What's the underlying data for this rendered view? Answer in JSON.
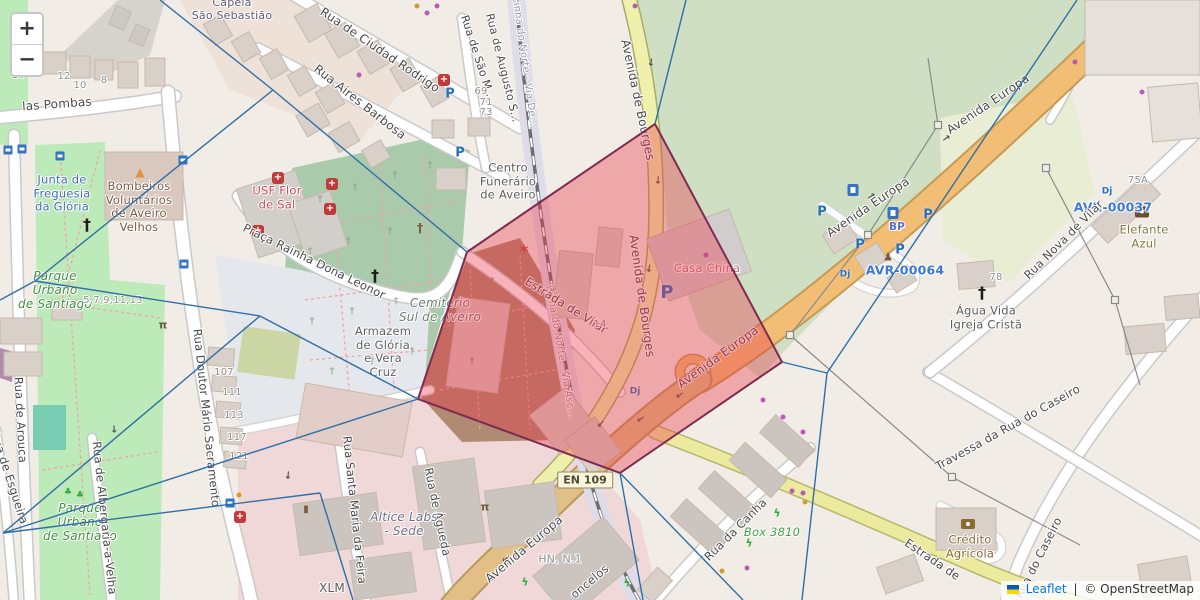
{
  "controls": {
    "zoom_in": "+",
    "zoom_out": "−"
  },
  "attribution": {
    "leaflet_link": "Leaflet",
    "separator": "|",
    "osm_text": "© OpenStreetMap"
  },
  "road_ref_badge": {
    "text": "EN 109",
    "x": 585,
    "y": 480
  },
  "overlay": {
    "voronoi_color": "#2f6fa8",
    "cell_stroke": "#7d2b50",
    "cell_fill": "rgba(235,55,70,0.38)",
    "cell_points": [
      [
        655,
        124
      ],
      [
        782,
        362
      ],
      [
        620,
        473
      ],
      [
        418,
        399
      ],
      [
        467,
        252
      ],
      [
        533,
        207
      ]
    ],
    "voronoi_segments": [
      [
        [
          160,
          0
        ],
        [
          273,
          90
        ]
      ],
      [
        [
          273,
          90
        ],
        [
          467,
          252
        ]
      ],
      [
        [
          35,
          281
        ],
        [
          273,
          90
        ]
      ],
      [
        [
          0,
          300
        ],
        [
          35,
          281
        ]
      ],
      [
        [
          35,
          281
        ],
        [
          260,
          316
        ]
      ],
      [
        [
          260,
          316
        ],
        [
          418,
          399
        ]
      ],
      [
        [
          260,
          316
        ],
        [
          3,
          533
        ]
      ],
      [
        [
          3,
          533
        ],
        [
          320,
          493
        ]
      ],
      [
        [
          320,
          493
        ],
        [
          353,
          600
        ]
      ],
      [
        [
          3,
          533
        ],
        [
          418,
          399
        ]
      ],
      [
        [
          620,
          473
        ],
        [
          643,
          600
        ]
      ],
      [
        [
          620,
          473
        ],
        [
          743,
          600
        ]
      ],
      [
        [
          655,
          124
        ],
        [
          686,
          0
        ]
      ],
      [
        [
          1077,
          0
        ],
        [
          827,
          373
        ]
      ],
      [
        [
          827,
          373
        ],
        [
          782,
          362
        ]
      ],
      [
        [
          827,
          373
        ],
        [
          802,
          600
        ]
      ]
    ]
  },
  "power_lines": [
    {
      "d": "M928,58 L938,125 L868,235 L790,335 L952,477 L1080,545",
      "pylons": [
        [
          938,
          125
        ],
        [
          868,
          235
        ],
        [
          790,
          335
        ],
        [
          952,
          477
        ]
      ]
    },
    {
      "d": "M1046,168 L1115,300 L1140,385",
      "pylons": [
        [
          1046,
          168
        ],
        [
          1115,
          300
        ]
      ]
    }
  ],
  "labels": [
    {
      "n": "street-rua-das-pombas",
      "t": "las Pombas",
      "x": 57,
      "y": 104,
      "r": -4,
      "s": 12
    },
    {
      "n": "poi-capela-sao-sebastiao",
      "t": "Capela\nSão Sebastião",
      "x": 232,
      "y": 10,
      "s": 11,
      "c": "#5b5b74"
    },
    {
      "n": "street-ciudad-rodrigo",
      "t": "Rua de Ciudad Rodrigo",
      "x": 380,
      "y": 50,
      "r": 34,
      "s": 12
    },
    {
      "n": "street-aires-barbosa",
      "t": "Rua Aires Barbosa",
      "x": 360,
      "y": 102,
      "r": 38,
      "s": 12
    },
    {
      "n": "street-sao-m",
      "t": "Rua de São M...",
      "x": 477,
      "y": 58,
      "r": 72,
      "s": 11
    },
    {
      "n": "street-augusto-s",
      "t": "Rua de Augusto S...",
      "x": 502,
      "y": 68,
      "r": 76,
      "s": 11
    },
    {
      "n": "railway-linha-do-norte-1",
      "t": "Linha do Norte - Via De...",
      "x": 524,
      "y": 62,
      "r": 82,
      "s": 10,
      "c": "#9595ab"
    },
    {
      "n": "railway-linha-do-norte-2",
      "t": "Linha do Norte - Via Asc...",
      "x": 560,
      "y": 352,
      "r": 80,
      "s": 10,
      "c": "#a08a93"
    },
    {
      "n": "road-bourges-1",
      "t": "Avenida de Bourges",
      "x": 638,
      "y": 100,
      "r": 78,
      "s": 12
    },
    {
      "n": "road-bourges-2",
      "t": "Avenida de Bourges",
      "x": 642,
      "y": 296,
      "r": 82,
      "s": 12
    },
    {
      "n": "poi-centro-funerario",
      "t": "Centro\nFunerário\nde Aveiro",
      "x": 508,
      "y": 182,
      "s": 11.5,
      "c": "#5d5d5d"
    },
    {
      "n": "poi-junta-freguesia",
      "t": "Junta de\nFreguesia\nda Glória",
      "x": 62,
      "y": 194,
      "s": 11.5,
      "c": "#3f6fb5"
    },
    {
      "n": "poi-bombeiros",
      "t": "Bombeiros\nVoluntários\nde Aveiro\nVelhos",
      "x": 139,
      "y": 207,
      "s": 11.5,
      "c": "#7a5948"
    },
    {
      "n": "poi-usf-flor-de-sal",
      "t": "USF Flor\nde Sal",
      "x": 277,
      "y": 198,
      "s": 11.5,
      "c": "#c5494f"
    },
    {
      "n": "street-praca-leonor",
      "t": "Praça Rainha Dona Leonor",
      "x": 314,
      "y": 262,
      "r": 26,
      "s": 11.5
    },
    {
      "n": "poi-parque-santiago-1",
      "t": "Parque\nUrbano\nde Santiago",
      "x": 55,
      "y": 290,
      "s": 12,
      "c": "#3f9143",
      "st": "i"
    },
    {
      "n": "poi-parque-santiago-2",
      "t": "Parque\nUrbano\nde Santiago",
      "x": 80,
      "y": 522,
      "s": 12,
      "c": "#3f9143",
      "st": "i"
    },
    {
      "n": "housenumbers-5-13",
      "t": "5,7,9,11,13",
      "x": 113,
      "y": 301,
      "s": 10,
      "c": "#8f8f8f"
    },
    {
      "n": "street-arouca",
      "t": "Rua de Arouca",
      "x": 20,
      "y": 420,
      "r": 87,
      "s": 11.5
    },
    {
      "n": "street-sacramento",
      "t": "Rua Doutor Mário Sacramento",
      "x": 206,
      "y": 418,
      "r": 84,
      "s": 11.5
    },
    {
      "n": "street-santa-maria",
      "t": "Rua Santa Maria da Feira",
      "x": 354,
      "y": 510,
      "r": 84,
      "s": 11.5
    },
    {
      "n": "street-agueda",
      "t": "Rua de Águeda",
      "x": 437,
      "y": 512,
      "r": 78,
      "s": 11.5
    },
    {
      "n": "street-albergaria",
      "t": "Rua de Albergaria-a-Velha",
      "x": 104,
      "y": 518,
      "r": 84,
      "s": 11.5
    },
    {
      "n": "street-esgueira",
      "t": "Rua de Esgueira",
      "x": 9,
      "y": 478,
      "r": 72,
      "s": 11.5
    },
    {
      "n": "poi-cemiterio-sul",
      "t": "Cemitério\nSul de Aveiro",
      "x": 440,
      "y": 310,
      "s": 12,
      "c": "#6f7f70",
      "st": "i"
    },
    {
      "n": "poi-armazem",
      "t": "Armazem\nde Glória\ne Vera\nCruz",
      "x": 383,
      "y": 352,
      "s": 11.5,
      "c": "#5f5f5f"
    },
    {
      "n": "street-estrada-vilar",
      "t": "Estrada de Vilar",
      "x": 566,
      "y": 306,
      "r": 32,
      "s": 11.5
    },
    {
      "n": "poi-casa-china",
      "t": "Casa China",
      "x": 707,
      "y": 269,
      "s": 11.5,
      "c": "#c06a75"
    },
    {
      "n": "road-europa-1",
      "t": "Avenida Europa",
      "x": 988,
      "y": 104,
      "r": -34,
      "s": 12
    },
    {
      "n": "road-europa-2",
      "t": "Avenida Europa",
      "x": 868,
      "y": 207,
      "r": -34,
      "s": 12
    },
    {
      "n": "road-europa-3",
      "t": "Avenida Europa",
      "x": 718,
      "y": 357,
      "r": -36,
      "s": 12
    },
    {
      "n": "road-europa-4",
      "t": "Avenida Europa",
      "x": 524,
      "y": 549,
      "r": -40,
      "s": 12
    },
    {
      "n": "marker-avr-00064",
      "t": "AVR-00064",
      "x": 905,
      "y": 271,
      "s": 12.5,
      "c": "#3b78d8",
      "w": "600"
    },
    {
      "n": "marker-avr-00037",
      "t": "AVR-00037",
      "x": 1113,
      "y": 208,
      "s": 12.5,
      "c": "#3b78d8",
      "w": "600"
    },
    {
      "n": "poi-bp",
      "t": "BP",
      "x": 897,
      "y": 227,
      "s": 10.5,
      "c": "#5a6fd8",
      "w": "700"
    },
    {
      "n": "poi-elefante-azul",
      "t": "Elefante\nAzul",
      "x": 1144,
      "y": 237,
      "s": 11.5,
      "c": "#87793f"
    },
    {
      "n": "poi-agua-vida",
      "t": "Água Vida\nIgreja Cristã",
      "x": 986,
      "y": 318,
      "s": 11.5,
      "c": "#5d5d5d"
    },
    {
      "n": "street-nova-vilar",
      "t": "Rua Nova de Vilar",
      "x": 1064,
      "y": 240,
      "r": -45,
      "s": 11.5
    },
    {
      "n": "street-travessa-caseiro",
      "t": "Travessa da Rua do Caseiro",
      "x": 1008,
      "y": 428,
      "r": -29,
      "s": 11.5
    },
    {
      "n": "street-caseiro",
      "t": "Rua do Caseiro",
      "x": 1039,
      "y": 558,
      "r": -63,
      "s": 11.5
    },
    {
      "n": "road-estrada-se",
      "t": "Estrada de",
      "x": 932,
      "y": 560,
      "r": 34,
      "s": 11.5
    },
    {
      "n": "poi-credito-agricola",
      "t": "Crédito\nAgrícola",
      "x": 970,
      "y": 547,
      "s": 11.5,
      "c": "#8a6a2f"
    },
    {
      "n": "street-canha",
      "t": "Rua da Canha",
      "x": 736,
      "y": 530,
      "r": -45,
      "s": 11.5
    },
    {
      "n": "poi-box-3810",
      "t": "Box 3810",
      "x": 772,
      "y": 533,
      "s": 11.5,
      "c": "#41a148",
      "st": "i"
    },
    {
      "n": "poi-xlm",
      "t": "XLM",
      "x": 332,
      "y": 588,
      "s": 12,
      "c": "#5d5d5d"
    },
    {
      "n": "poi-hn-n1",
      "t": "HN, N.1",
      "x": 560,
      "y": 560,
      "s": 11,
      "c": "#909090"
    },
    {
      "n": "street-vasconcelos",
      "t": "oncelos",
      "x": 590,
      "y": 582,
      "r": -40,
      "s": 11.5
    },
    {
      "n": "poi-altice-labs",
      "t": "Altice Labs\n- Sede",
      "x": 404,
      "y": 524,
      "s": 12,
      "c": "#6e6e85",
      "st": "i"
    },
    {
      "n": "housenumber",
      "t": "14",
      "x": 18,
      "y": 76,
      "s": 10,
      "c": "#8f8f8f"
    },
    {
      "n": "housenumber",
      "t": "12",
      "x": 64,
      "y": 77,
      "s": 10,
      "c": "#8f8f8f"
    },
    {
      "n": "housenumber",
      "t": "10",
      "x": 80,
      "y": 86,
      "s": 10,
      "c": "#8f8f8f"
    },
    {
      "n": "housenumber",
      "t": "8",
      "x": 104,
      "y": 81,
      "s": 10,
      "c": "#8f8f8f"
    },
    {
      "n": "housenumber",
      "t": "69",
      "x": 481,
      "y": 92,
      "s": 10,
      "c": "#8f8f8f"
    },
    {
      "n": "housenumber",
      "t": "71",
      "x": 486,
      "y": 103,
      "s": 10,
      "c": "#8f8f8f"
    },
    {
      "n": "housenumber",
      "t": "73",
      "x": 486,
      "y": 113,
      "s": 10,
      "c": "#8f8f8f"
    },
    {
      "n": "housenumber",
      "t": "107",
      "x": 224,
      "y": 373,
      "s": 10,
      "c": "#8f8f8f"
    },
    {
      "n": "housenumber",
      "t": "111",
      "x": 232,
      "y": 393,
      "s": 10,
      "c": "#8f8f8f"
    },
    {
      "n": "housenumber",
      "t": "113",
      "x": 234,
      "y": 416,
      "s": 10,
      "c": "#8f8f8f"
    },
    {
      "n": "housenumber",
      "t": "117",
      "x": 237,
      "y": 438,
      "s": 10,
      "c": "#8f8f8f"
    },
    {
      "n": "housenumber",
      "t": "121",
      "x": 239,
      "y": 457,
      "s": 10,
      "c": "#8f8f8f"
    },
    {
      "n": "housenumber",
      "t": "78",
      "x": 996,
      "y": 278,
      "s": 10,
      "c": "#8f8f8f"
    },
    {
      "n": "housenumber",
      "t": "75A",
      "x": 1138,
      "y": 181,
      "s": 10,
      "c": "#8f8f8f"
    },
    {
      "n": "housenumber",
      "t": "14",
      "x": 600,
      "y": 325,
      "s": 10,
      "c": "#8f8f8f"
    }
  ],
  "icons": [
    {
      "k": "parking-icon",
      "x": 450,
      "y": 94
    },
    {
      "k": "parking-icon",
      "x": 460,
      "y": 153
    },
    {
      "k": "parking-icon",
      "x": 822,
      "y": 212
    },
    {
      "k": "parking-icon",
      "x": 928,
      "y": 215
    },
    {
      "k": "parking-icon",
      "x": 860,
      "y": 245
    },
    {
      "k": "parking-icon",
      "x": 900,
      "y": 250
    },
    {
      "k": "parking-icon",
      "x": 667,
      "y": 293,
      "s": 18
    },
    {
      "k": "hospital-icon",
      "x": 444,
      "y": 80
    },
    {
      "k": "hospital-icon",
      "x": 278,
      "y": 178
    },
    {
      "k": "hospital-icon",
      "x": 332,
      "y": 184
    },
    {
      "k": "hospital-icon",
      "x": 330,
      "y": 209
    },
    {
      "k": "hospital-icon",
      "x": 258,
      "y": 231
    },
    {
      "k": "pharmacy-icon",
      "x": 240,
      "y": 517
    },
    {
      "k": "fuel-icon",
      "x": 853,
      "y": 190
    },
    {
      "k": "fuel-icon",
      "x": 893,
      "y": 213
    },
    {
      "k": "bus-stop-icon",
      "x": 8,
      "y": 150
    },
    {
      "k": "bus-stop-icon",
      "x": 22,
      "y": 149
    },
    {
      "k": "bus-stop-icon",
      "x": 60,
      "y": 156
    },
    {
      "k": "bus-stop-icon",
      "x": 183,
      "y": 160
    },
    {
      "k": "bus-stop-icon",
      "x": 184,
      "y": 264
    },
    {
      "k": "bus-stop-icon",
      "x": 230,
      "y": 503
    },
    {
      "k": "church-cross-icon",
      "x": 87,
      "y": 225
    },
    {
      "k": "church-cross-icon",
      "x": 375,
      "y": 276
    },
    {
      "k": "church-cross-icon",
      "x": 982,
      "y": 293
    },
    {
      "k": "monument-cross-icon",
      "x": 420,
      "y": 228
    },
    {
      "k": "fire-station-icon",
      "x": 140,
      "y": 172
    },
    {
      "k": "car-wash-icon",
      "x": 1142,
      "y": 212
    },
    {
      "k": "bank-icon",
      "x": 968,
      "y": 524
    },
    {
      "k": "fitness-icon",
      "x": 777,
      "y": 513
    },
    {
      "k": "fitness-icon",
      "x": 749,
      "y": 543
    },
    {
      "k": "fitness-icon",
      "x": 627,
      "y": 583
    },
    {
      "k": "fitness-icon",
      "x": 525,
      "y": 582
    },
    {
      "k": "picnic-icon",
      "x": 485,
      "y": 507
    },
    {
      "k": "picnic-icon",
      "x": 163,
      "y": 325
    },
    {
      "k": "monument-icon",
      "x": 306,
      "y": 510
    },
    {
      "k": "statue-icon",
      "x": 888,
      "y": 257
    },
    {
      "k": "playground-icon",
      "x": 68,
      "y": 493
    },
    {
      "k": "playground-icon",
      "x": 80,
      "y": 496
    },
    {
      "k": "level-crossing-icon",
      "x": 524,
      "y": 253
    },
    {
      "k": "charging-icon",
      "x": 845,
      "y": 275
    },
    {
      "k": "charging-icon",
      "x": 1107,
      "y": 192
    },
    {
      "k": "charging-icon",
      "x": 635,
      "y": 392
    },
    {
      "k": "shop-dot-purple",
      "x": 427,
      "y": 13
    },
    {
      "k": "shop-dot-purple",
      "x": 437,
      "y": 6
    },
    {
      "k": "shop-dot-purple",
      "x": 359,
      "y": 75
    },
    {
      "k": "shop-dot-purple",
      "x": 706,
      "y": 255
    },
    {
      "k": "shop-dot-purple",
      "x": 792,
      "y": 491
    },
    {
      "k": "shop-dot-purple",
      "x": 803,
      "y": 493
    },
    {
      "k": "shop-dot-purple",
      "x": 747,
      "y": 568
    },
    {
      "k": "shop-dot-purple",
      "x": 763,
      "y": 400
    },
    {
      "k": "shop-dot-purple",
      "x": 783,
      "y": 417
    },
    {
      "k": "shop-dot-purple",
      "x": 803,
      "y": 432
    },
    {
      "k": "shop-dot-purple",
      "x": 1075,
      "y": 62
    },
    {
      "k": "shop-dot-purple",
      "x": 1142,
      "y": 92
    },
    {
      "k": "shop-dot-purple",
      "x": 635,
      "y": 6
    },
    {
      "k": "shop-dot-orange",
      "x": 417,
      "y": 6
    },
    {
      "k": "shop-dot-orange",
      "x": 805,
      "y": 502
    },
    {
      "k": "shop-dot-orange",
      "x": 722,
      "y": 571
    },
    {
      "k": "shop-dot-orange",
      "x": 239,
      "y": 495
    },
    {
      "k": "grave-cross-green",
      "x": 320,
      "y": 200
    },
    {
      "k": "grave-cross-green",
      "x": 355,
      "y": 188
    },
    {
      "k": "grave-cross-green",
      "x": 395,
      "y": 176
    },
    {
      "k": "grave-cross-green",
      "x": 430,
      "y": 166
    },
    {
      "k": "grave-cross-green",
      "x": 310,
      "y": 252
    },
    {
      "k": "grave-cross-green",
      "x": 348,
      "y": 242
    },
    {
      "k": "grave-cross-green",
      "x": 390,
      "y": 232
    },
    {
      "k": "grave-cross-green",
      "x": 312,
      "y": 322
    },
    {
      "k": "grave-cross-green",
      "x": 352,
      "y": 312
    },
    {
      "k": "grave-cross-green",
      "x": 396,
      "y": 302
    },
    {
      "k": "grave-cross-green",
      "x": 332,
      "y": 372
    },
    {
      "k": "grave-cross-green",
      "x": 372,
      "y": 362
    },
    {
      "k": "grave-cross-green",
      "x": 412,
      "y": 352
    },
    {
      "k": "grave-cross-brown",
      "x": 452,
      "y": 300
    },
    {
      "k": "grave-cross-brown",
      "x": 492,
      "y": 282
    },
    {
      "k": "grave-cross-brown",
      "x": 522,
      "y": 322
    },
    {
      "k": "grave-cross-brown",
      "x": 472,
      "y": 362
    },
    {
      "k": "grave-cross-brown",
      "x": 512,
      "y": 392
    },
    {
      "k": "grave-cross-brown",
      "x": 542,
      "y": 352
    },
    {
      "k": "oneway-arrow",
      "x": 872,
      "y": 197,
      "r": -34
    },
    {
      "k": "oneway-arrow",
      "x": 947,
      "y": 139,
      "r": -34
    },
    {
      "k": "oneway-arrow",
      "x": 679,
      "y": 394,
      "r": 146
    },
    {
      "k": "oneway-arrow",
      "x": 640,
      "y": 418,
      "r": 146
    },
    {
      "k": "oneway-arrow",
      "x": 505,
      "y": 558,
      "r": 142
    },
    {
      "k": "oneway-arrow",
      "x": 650,
      "y": 62,
      "r": 97
    },
    {
      "k": "oneway-arrow",
      "x": 657,
      "y": 180,
      "r": 95
    },
    {
      "k": "oneway-arrow",
      "x": 648,
      "y": 268,
      "r": 100
    },
    {
      "k": "oneway-arrow",
      "x": 600,
      "y": 423,
      "r": 130
    },
    {
      "k": "oneway-arrow",
      "x": 287,
      "y": 475,
      "r": 95
    },
    {
      "k": "oneway-arrow",
      "x": 113,
      "y": 429,
      "r": 88
    }
  ]
}
